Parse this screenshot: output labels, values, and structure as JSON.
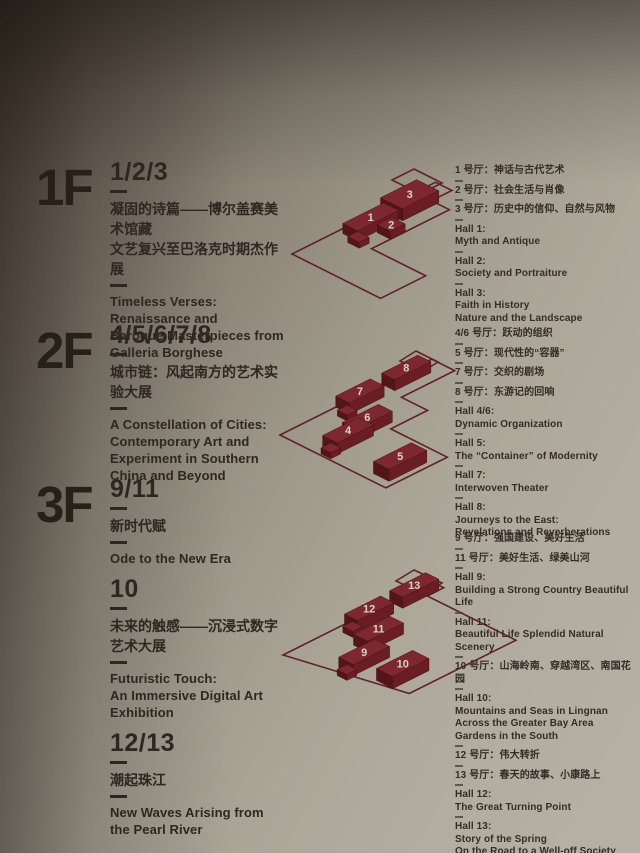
{
  "palette": {
    "wall_dark": "#453b31",
    "wall_light": "#b5b1a5",
    "text": "#2e2620",
    "block_top": "#7d2730",
    "block_left": "#541519",
    "block_right": "#6b1d24",
    "outline": "#5e2228",
    "number": "#d9d2c7"
  },
  "floors": [
    {
      "label": "1F",
      "sections": [
        {
          "range": "1/2/3",
          "zh": [
            "凝固的诗篇——博尔盖赛美术馆藏",
            "文艺复兴至巴洛克时期杰作展"
          ],
          "en": [
            "Timeless Verses:",
            "Renaissance and",
            "Baroque Masterpieces from",
            "Galleria Borghese"
          ]
        }
      ],
      "halls": [
        {
          "lines": [
            "1 号厅：神话与古代艺术"
          ]
        },
        {
          "lines": [
            "2 号厅：社会生活与肖像"
          ]
        },
        {
          "lines": [
            "3 号厅：历史中的信仰、自然与风物"
          ]
        },
        {
          "lines": [
            "Hall 1:",
            "Myth and Antique"
          ]
        },
        {
          "lines": [
            "Hall 2:",
            "Society and Portraiture"
          ]
        },
        {
          "lines": [
            "Hall 3:",
            "Faith in History",
            "Nature and the Landscape"
          ]
        }
      ]
    },
    {
      "label": "2F",
      "sections": [
        {
          "range": "4/5/6/7/8",
          "zh": [
            "城市链：风起南方的艺术实验大展"
          ],
          "en": [
            "A Constellation of Cities:",
            "Contemporary Art and",
            "Experiment in Southern",
            "China and Beyond"
          ]
        }
      ],
      "halls": [
        {
          "lines": [
            "4/6 号厅：跃动的组织"
          ]
        },
        {
          "lines": [
            "5 号厅：现代性的“容器”"
          ]
        },
        {
          "lines": [
            "7 号厅：交织的剧场"
          ]
        },
        {
          "lines": [
            "8 号厅：东游记的回响"
          ]
        },
        {
          "lines": [
            "Hall 4/6:",
            "Dynamic Organization"
          ]
        },
        {
          "lines": [
            "Hall 5:",
            "The “Container” of Modernity"
          ]
        },
        {
          "lines": [
            "Hall 7:",
            "Interwoven Theater"
          ]
        },
        {
          "lines": [
            "Hall 8:",
            "Journeys to the East:",
            "Revelations and Reverberations"
          ]
        }
      ]
    },
    {
      "label": "3F",
      "sections": [
        {
          "range": "9/11",
          "zh": [
            "新时代赋"
          ],
          "en": [
            "Ode to the New Era"
          ]
        },
        {
          "range": "10",
          "zh": [
            "未来的触感——沉浸式数字艺术大展"
          ],
          "en": [
            "Futuristic Touch:",
            "An Immersive Digital Art",
            "Exhibition"
          ]
        },
        {
          "range": "12/13",
          "zh": [
            "潮起珠江"
          ],
          "en": [
            "New Waves Arising from",
            "the Pearl River"
          ]
        }
      ],
      "halls": [
        {
          "lines": [
            "9 号厅：强国建设、美好生活"
          ]
        },
        {
          "lines": [
            "11 号厅：美好生活、绿美山河"
          ]
        },
        {
          "lines": [
            "Hall 9:",
            "Building a Strong Country Beautiful Life"
          ]
        },
        {
          "lines": [
            "Hall 11:",
            "Beautiful Life Splendid Natural Scenery"
          ]
        },
        {
          "lines": [
            "10 号厅：山海岭南、穿越湾区、南国花园"
          ]
        },
        {
          "lines": [
            "Hall 10:",
            "Mountains and Seas in Lingnan",
            "Across the Greater Bay Area",
            "Gardens in the South"
          ]
        },
        {
          "lines": [
            "12 号厅：伟大转折"
          ]
        },
        {
          "lines": [
            "13 号厅：春天的故事、小康路上"
          ]
        },
        {
          "lines": [
            "Hall 12:",
            "The Great Turning Point"
          ]
        },
        {
          "lines": [
            "Hall 13:",
            "Story of the Spring",
            "On the Road to a Well-off Society"
          ]
        }
      ]
    }
  ],
  "diagrams": [
    {
      "box": [
        286,
        166,
        200,
        140
      ],
      "origin": [
        6,
        88
      ],
      "outline": [
        [
          6,
          88
        ],
        [
          149.5,
          16.3
        ],
        [
          165.9,
          24.5
        ],
        [
          145.4,
          34.7
        ],
        [
          163.4,
          43.7
        ],
        [
          85.5,
          82.7
        ],
        [
          139.7,
          109.8
        ],
        [
          94.6,
          132.3
        ]
      ],
      "end_rect": [
        [
          128,
          3
        ],
        [
          156,
          17
        ],
        [
          134,
          28
        ],
        [
          106,
          14
        ]
      ],
      "blocks": [
        {
          "n": "3",
          "u": 108,
          "v": 0,
          "du": 44,
          "dv": 27,
          "h": 12
        },
        {
          "n": "1",
          "u": 56,
          "v": 6,
          "du": 50,
          "dv": 18,
          "h": 10
        },
        {
          "n": "",
          "u": 48,
          "v": 20,
          "du": 12,
          "dv": 14,
          "h": 6
        },
        {
          "n": "2",
          "u": 78,
          "v": 26,
          "du": 18,
          "dv": 16,
          "h": 8
        }
      ]
    },
    {
      "box": [
        278,
        338,
        240,
        170
      ],
      "origin": [
        2,
        97
      ],
      "outline": [
        [
          2,
          97
        ],
        [
          153.7,
          21.2
        ],
        [
          176.7,
          32.6
        ],
        [
          123.4,
          59.3
        ],
        [
          149.6,
          72.4
        ],
        [
          112.7,
          90.9
        ],
        [
          169.3,
          119.2
        ],
        [
          107.8,
          149.9
        ]
      ],
      "end_rect": [
        [
          138,
          13
        ],
        [
          160,
          24
        ],
        [
          144,
          34
        ],
        [
          122,
          23
        ]
      ],
      "blocks": [
        {
          "n": "8",
          "u": 124,
          "v": 0,
          "du": 44,
          "dv": 16,
          "h": 11
        },
        {
          "n": "7",
          "u": 68,
          "v": 0,
          "du": 42,
          "dv": 17,
          "h": 11
        },
        {
          "n": "",
          "u": 58,
          "v": 12,
          "du": 12,
          "dv": 12,
          "h": 6
        },
        {
          "n": "6",
          "u": 40,
          "v": 36,
          "du": 44,
          "dv": 17,
          "h": 11
        },
        {
          "n": "4",
          "u": 12,
          "v": 40,
          "du": 44,
          "dv": 18,
          "h": 11
        },
        {
          "n": "",
          "u": 2,
          "v": 48,
          "du": 12,
          "dv": 12,
          "h": 6
        },
        {
          "n": "5",
          "u": 10,
          "v": 104,
          "du": 46,
          "dv": 19,
          "h": 12
        }
      ]
    },
    {
      "box": [
        278,
        556,
        250,
        175
      ],
      "origin": [
        5,
        99
      ],
      "outline": [
        [
          5,
          99
        ],
        [
          152.6,
          25.2
        ],
        [
          165.7,
          31.8
        ],
        [
          149.3,
          40
        ],
        [
          237.9,
          84.2
        ],
        [
          131.3,
          137.5
        ]
      ],
      "end_rect": [
        [
          136,
          14
        ],
        [
          164,
          27
        ],
        [
          146,
          38
        ],
        [
          118,
          25
        ]
      ],
      "blocks": [
        {
          "n": "13",
          "u": 130,
          "v": 0,
          "du": 44,
          "dv": 16,
          "h": 11
        },
        {
          "n": "12",
          "u": 74,
          "v": 1,
          "du": 44,
          "dv": 16,
          "h": 11
        },
        {
          "n": "",
          "u": 64,
          "v": 9,
          "du": 12,
          "dv": 12,
          "h": 6
        },
        {
          "n": "11",
          "u": 55,
          "v": 31,
          "du": 44,
          "dv": 17,
          "h": 11
        },
        {
          "n": "9",
          "u": 18,
          "v": 50,
          "du": 44,
          "dv": 18,
          "h": 11
        },
        {
          "n": "",
          "u": 8,
          "v": 58,
          "du": 12,
          "dv": 12,
          "h": 6
        },
        {
          "n": "10",
          "u": 26,
          "v": 88,
          "du": 44,
          "dv": 20,
          "h": 12
        }
      ]
    }
  ]
}
